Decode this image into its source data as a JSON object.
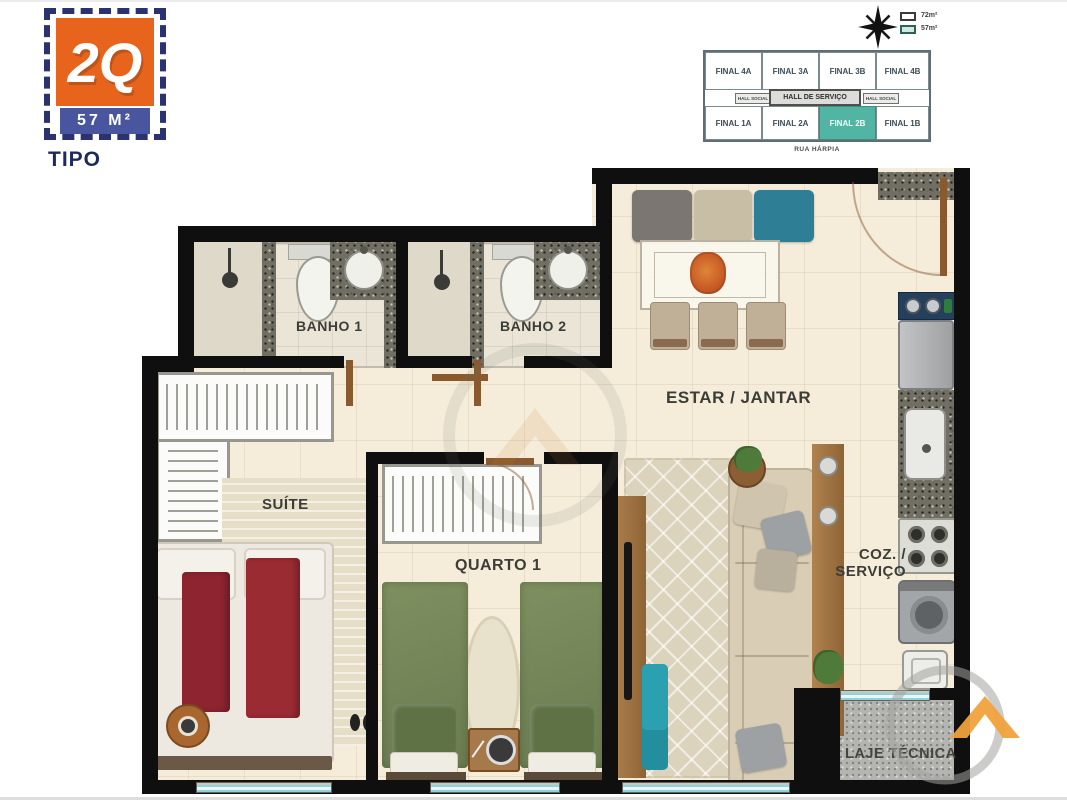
{
  "logo": {
    "badge": "2Q",
    "area_band": "57 M²",
    "caption": "TIPO"
  },
  "keyplan": {
    "units_top": [
      "FINAL 4A",
      "FINAL 3A",
      "FINAL 3B",
      "FINAL 4B"
    ],
    "units_bottom": [
      "FINAL 1A",
      "FINAL 2A",
      "FINAL 2B",
      "FINAL 1B"
    ],
    "hall_social_left": "HALL SOCIAL",
    "hall_servico": "HALL DE SERVIÇO",
    "hall_social_right": "HALL SOCIAL",
    "highlighted_unit": "FINAL 2B",
    "street": "RUA HÁRPIA",
    "legend": [
      {
        "label": "72m²"
      },
      {
        "label": "57m²"
      }
    ]
  },
  "floorplan": {
    "rooms": {
      "banho1": "BANHO 1",
      "banho2": "BANHO 2",
      "estar_jantar": "ESTAR / JANTAR",
      "suite": "SUÍTE",
      "quarto1": "QUARTO 1",
      "coz_line1": "COZ. /",
      "coz_line2": "SERVIÇO",
      "laje": "LAJE TÉCNICA"
    }
  },
  "colors": {
    "accent_orange": "#E8631C",
    "logo_blue": "#4A55A0",
    "navy_text": "#1E2A5E",
    "keyplan_teal": "#52B5A4",
    "wall_black": "#0F0F0F",
    "floor_cream": "#F5EDDA",
    "window_teal": "#8ED2DA",
    "bed_green": "#76885A",
    "bed_red": "#8E2430",
    "sofa_beige": "#D9CEB5",
    "wood": "#A6794A",
    "watermark_orange": "#F0A23C"
  }
}
